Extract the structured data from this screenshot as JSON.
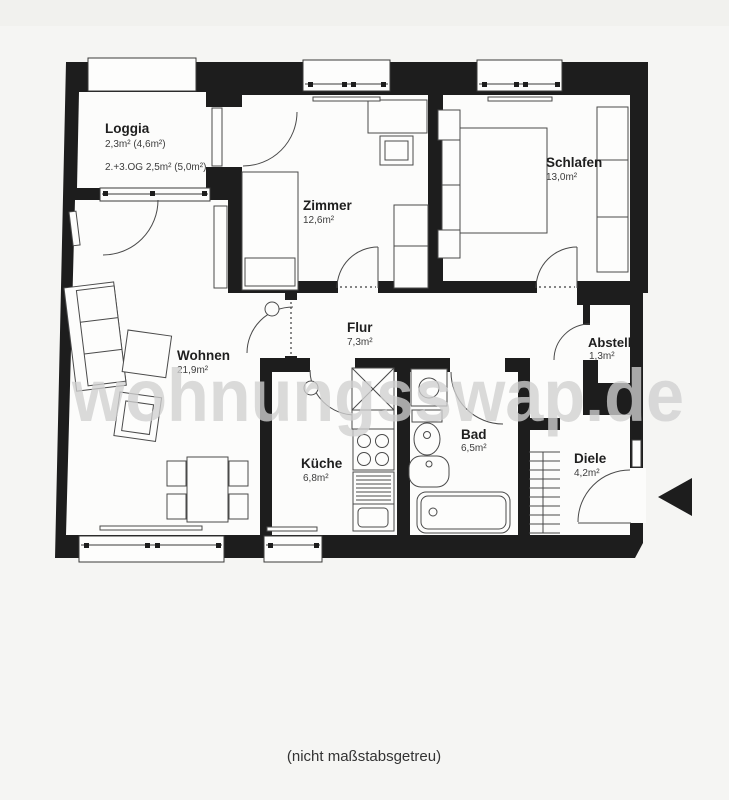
{
  "page": {
    "note": "(nicht maßstabsgetreu)"
  },
  "watermark": {
    "text": "wohnungsswap.de"
  },
  "colors": {
    "wall": "#1d1d1d",
    "floor": "#fcfcfb",
    "furniture_line": "#4a4a4a",
    "label": "#1f1f1f",
    "area_label": "#3d3d3d",
    "watermark": "#cfcfcf",
    "background": "#f5f5f3"
  },
  "rooms": [
    {
      "id": "loggia",
      "name": "Loggia",
      "area": "2,3m² (4,6m²)",
      "extra": "2.+3.OG 2,5m² (5,0m²)"
    },
    {
      "id": "zimmer",
      "name": "Zimmer",
      "area": "12,6m²"
    },
    {
      "id": "schlafen",
      "name": "Schlafen",
      "area": "13,0m²"
    },
    {
      "id": "wohnen",
      "name": "Wohnen",
      "area": "21,9m²"
    },
    {
      "id": "flur",
      "name": "Flur",
      "area": "7,3m²"
    },
    {
      "id": "kueche",
      "name": "Küche",
      "area": "6,8m²"
    },
    {
      "id": "bad",
      "name": "Bad",
      "area": "6,5m²"
    },
    {
      "id": "abstell",
      "name": "Abstell",
      "area": "1,3m²"
    },
    {
      "id": "diele",
      "name": "Diele",
      "area": "4,2m²"
    }
  ]
}
